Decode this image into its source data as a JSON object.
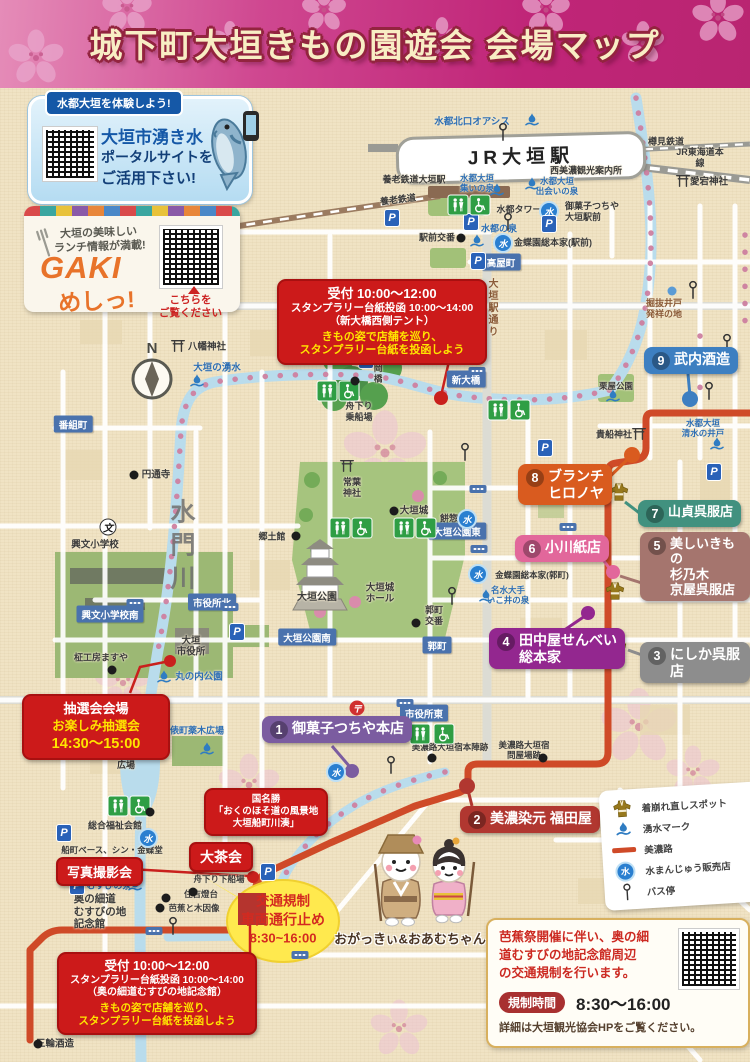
{
  "title": "城下町大垣きもの園遊会 会場マップ",
  "promo_water": {
    "badge": "水都大垣を体験しよう!",
    "line1": "大垣市湧き水",
    "line2": "ポータルサイトを",
    "line3": "ご活用下さい!"
  },
  "promo_gaki": {
    "tag1": "大垣の美味しい",
    "tag2": "ランチ情報が満載!",
    "logo1": "GAKI",
    "logo2": "めしっ!",
    "note": "こちらを\nご覧ください"
  },
  "notices": {
    "top": {
      "l1": "受付 10:00～12:00",
      "l2": "スタンプラリー台紙投函 10:00～14:00",
      "l3": "（新大橋西側テント）",
      "l4": "きもの姿で店舗を巡り、",
      "l5": "スタンプラリー台紙を投函しよう"
    },
    "bottom": {
      "l1": "受付 10:00～12:00",
      "l2": "スタンプラリー台紙投函 10:00～14:00",
      "l3": "（奥の細道むすびの地記念館）",
      "l4": "きもの姿で店舗を巡り、",
      "l5": "スタンプラリー台紙を投函しよう"
    },
    "lottery": {
      "l1": "抽選会会場",
      "l2": "お楽しみ抽選会",
      "l3": "14:30～15:00"
    },
    "photo": "写真撮影会",
    "tea": "大茶会",
    "scenic": {
      "l1": "国名勝",
      "l2": "「おくのほそ道の風景地",
      "l3": "大垣船町川湊」"
    },
    "traffic": {
      "l1": "交通規制",
      "l2": "車両通行止め",
      "l3": "8:30~16:00"
    }
  },
  "spots": [
    {
      "num": "1",
      "label": "御菓子つちや本店",
      "color": "#7b5ca0"
    },
    {
      "num": "2",
      "label": "美濃染元 福田屋",
      "color": "#b13730"
    },
    {
      "num": "3",
      "label": "にしか呉服店",
      "color": "#8d8d8d"
    },
    {
      "num": "4",
      "label": "田中屋せんべい\n総本家",
      "color": "#93278f"
    },
    {
      "num": "5",
      "label": "美しいきもの\n杉乃木\n京屋呉服店",
      "color": "#a5756e"
    },
    {
      "num": "6",
      "label": "小川紙店",
      "color": "#e2679b"
    },
    {
      "num": "7",
      "label": "山貞呉服店",
      "color": "#41917f"
    },
    {
      "num": "8",
      "label": "ブランチ\nヒロノヤ",
      "color": "#d95b1f"
    },
    {
      "num": "9",
      "label": "武内酒造",
      "color": "#3d7fc1"
    }
  ],
  "legend": {
    "items": [
      {
        "icon": "kimono-icon",
        "label": "着崩れ直しスポット"
      },
      {
        "icon": "spring-icon",
        "label": "湧水マーク"
      },
      {
        "icon": "route-line",
        "label": "美濃路"
      },
      {
        "icon": "mizu-manju-icon",
        "label": "水まんじゅう販売店"
      },
      {
        "icon": "bus-stop-icon",
        "label": "バス停"
      }
    ]
  },
  "info_card": {
    "message": "芭蕉祭開催に伴い、奥の細\n道むすびの地記念館周辺\nの交通規制を行います。",
    "badge": "規制時間",
    "time": "8:30～16:00",
    "note": "詳細は大垣観光協会HPをご覧ください。"
  },
  "characters": "おがっきぃ&おあむちゃん",
  "labels": {
    "oasis": "水都北口オアシス",
    "jr": "JR大垣駅",
    "tarumi": "樽見鉄道",
    "tokaido": "JR東海道本線",
    "kanko": "西美濃観光案内所",
    "yoro_sta": "養老鉄道大垣駅",
    "yoro": "養老鉄道",
    "tsudoi": "水都大垣\n集いの泉",
    "deai": "水都大垣\n出会いの泉",
    "atago": "愛宕神社",
    "tower": "水都タワー",
    "tsuchiya_eki": "御菓子つちや\n大垣駅前",
    "suito_izumi": "水都の泉",
    "koban_eki": "駅前交番",
    "kincho_eki": "金蝶園総本家(駅前)",
    "takaya": "高屋町",
    "horinuki": "掘抜井戸\n発祥の地",
    "ogaki_dori": "大垣駅通り",
    "shin_ohashi": "新大橋",
    "takaoka": "高岡橋",
    "funa_nori": "舟下り\n乗船場",
    "yawata": "八幡神社",
    "yusui": "大垣の湧水",
    "bangumi": "番組町",
    "entsuji": "円通寺",
    "kobun": "興文小学校",
    "suimon": "水門川",
    "kyodo": "郷土館",
    "tokiwa": "常葉\n神社",
    "ogakijo": "大垣城",
    "mochiso": "餅惣",
    "park_east": "大垣公園東",
    "park": "大垣公園",
    "hall": "大垣城\nホール",
    "kuruwa_koban": "郭町\n交番",
    "kuruwa": "郭町",
    "park_south": "大垣公園南",
    "cityhall_n": "市役所北",
    "kobun_s": "興文小学校南",
    "cityhall": "大垣\n市役所",
    "marunouchi": "丸の内公園",
    "masaya": "柾工房ますや",
    "tawara": "俵町薬木広場",
    "shiki": "四季の\n広場",
    "cityhall_e": "市役所東",
    "honjin": "美濃路大垣宿本陣跡",
    "toiyaba": "美濃路大垣宿\n問屋場跡",
    "fukushi": "総合福祉会館",
    "funamachi_base": "船町ベース、シン・金蝶堂",
    "musubi_izumi": "むすびの泉",
    "kinenkan": "奥の細道\nむすびの地\n記念館",
    "funa_gesen": "舟下り下船場",
    "sumiyoshi": "住吉燈台",
    "basho": "芭蕉と木因像",
    "miwa": "三輪酒造",
    "kifune": "貴船神社",
    "kuriya": "栗屋公園",
    "shimizu": "水都大垣\n清水の井戸",
    "meisui": "名水大手\nいこ井の泉",
    "kincho_kuruwa": "金蝶園総本家(郭町)",
    "compass_n": "N"
  },
  "icons": {
    "spring-icon": "blue water-splash droplet",
    "mizu-manju-icon": "blue circle with 水",
    "parking-icon": "blue square P",
    "toilet-icon": "green square with figures",
    "wheelchair-icon": "green square wheelchair",
    "bus-stop-icon": "pole with ring",
    "kimono-icon": "gold kimono",
    "torii-icon": "shrine gate",
    "post-office-icon": "red circle 〒",
    "school-icon": "circle 文",
    "crossing-signal-icon": "blue tab with dots"
  },
  "colors": {
    "route_minoji": "#cf4a28",
    "river": "#b9dcec",
    "banner": "#c02578",
    "notice_red": "#cc1a1a",
    "traffic_yellow": "#ffe94e"
  }
}
